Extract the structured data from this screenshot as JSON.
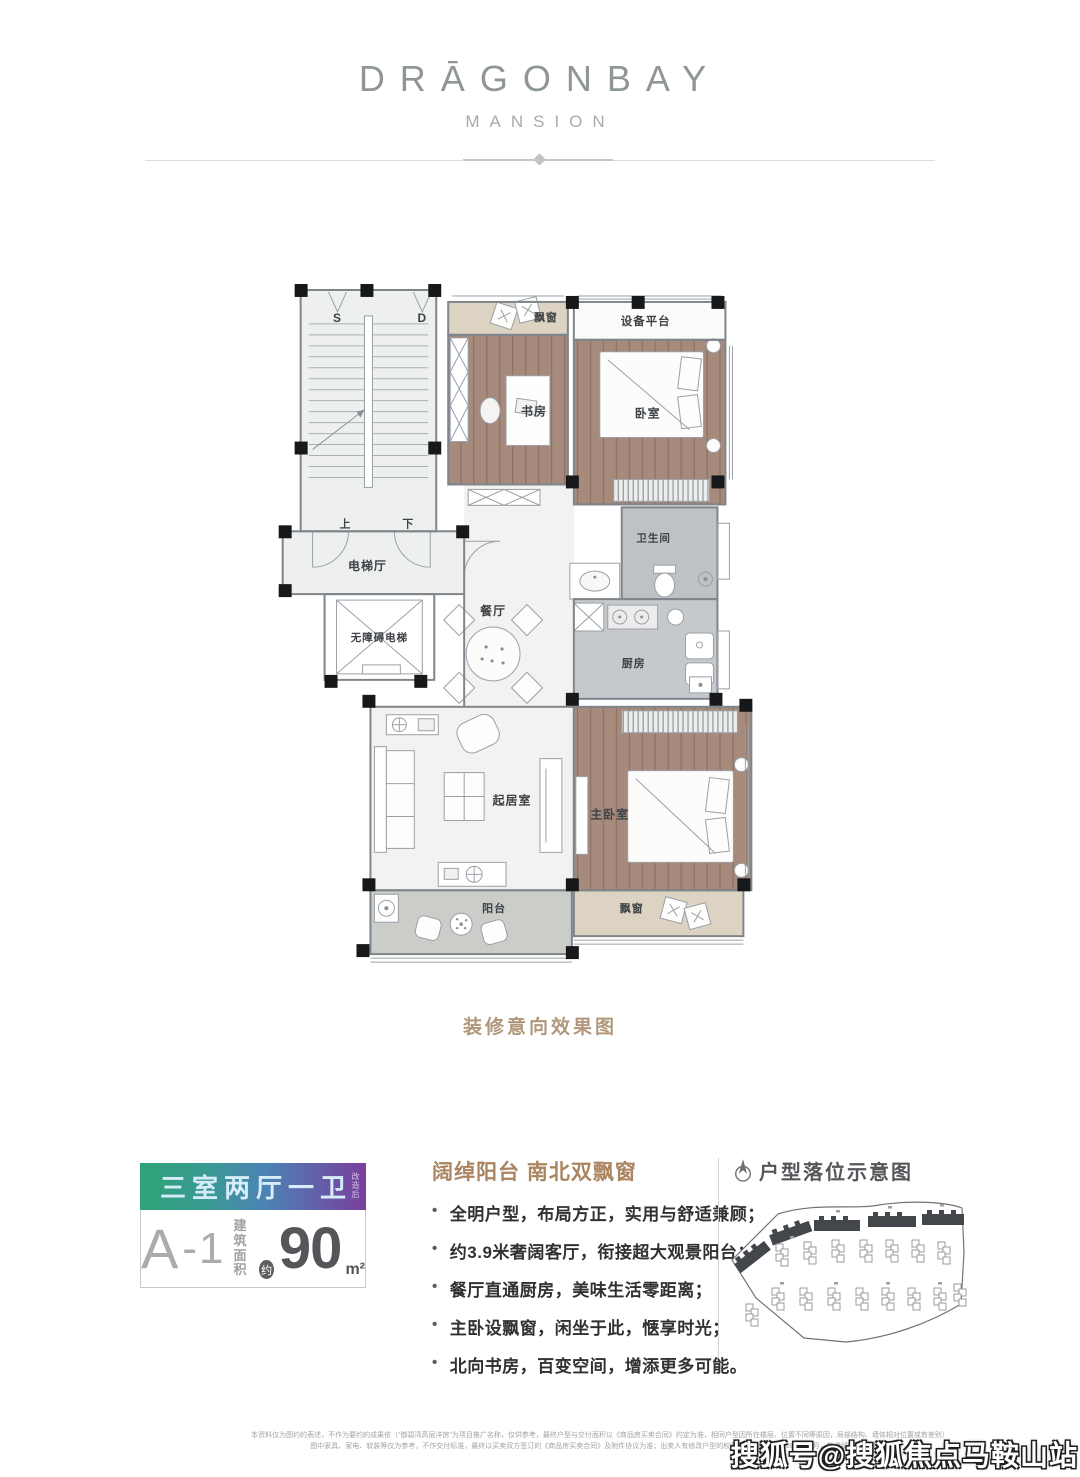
{
  "brand": {
    "name": "DRĀGONBAY",
    "subtitle": "MANSION"
  },
  "plan": {
    "caption": "装修意向效果图",
    "labels": {
      "stair_s": "S",
      "stair_d": "D",
      "bay_top": "飘窗",
      "equipment": "设备平台",
      "study": "书房",
      "bedroom": "卧室",
      "up": "上",
      "down": "下",
      "elevator_hall": "电梯厅",
      "accessible_elevator": "无障碍电梯",
      "dining": "餐厅",
      "bathroom": "卫生间",
      "kitchen": "厨房",
      "living": "起居室",
      "master_bedroom": "主卧室",
      "balcony": "阳台",
      "bay_bottom": "飘窗"
    }
  },
  "unit": {
    "headline": "三室两厅一卫",
    "headline_note": "改造后",
    "code_letter": "A",
    "code_suffix": "-1",
    "area_label_line1": "建筑",
    "area_label_line2": "面积",
    "approx": "约",
    "area_value": "90",
    "area_unit": "m²",
    "colors": {
      "gradient_left": "#2ea377",
      "gradient_mid": "#4b83b4",
      "gradient_right": "#7a3f9e",
      "headline_text": "#d6ecf8",
      "feature_title": "#aa855f",
      "caption": "#b1977c"
    }
  },
  "features": {
    "title": "阔绰阳台 南北双飘窗",
    "items": [
      "全明户型，布局方正，实用与舒适兼顾；",
      "约3.9米奢阔客厅，衔接超大观景阳台；",
      "餐厅直通厨房，美味生活零距离；",
      "主卧设飘窗，闲坐于此，惬享时光；",
      "北向书房，百变空间，增添更多可能。"
    ]
  },
  "sitemap": {
    "title": "户型落位示意图"
  },
  "disclaimer": {
    "line1": "本资料仅为图约的表述，不作为要约的成果依（“御碧湾高层洋房”为项目推广名称，仅供参考，最终户型与交付面积以《商品房买卖合同》约定为准，相同户型因所在楼层、位置不同等原因，局部结构、墙体相对位置或有差别）",
    "line2": "图中家具、家电、软装等仅为参考，不作交付标准，最终以买卖双方签订的《商品房买卖合同》及附件协议为准；出卖人有修改户型的权利；本资料发布于2020年7月，敬请留意最新资料。"
  },
  "watermark": "搜狐号@搜狐焦点马鞍山站"
}
